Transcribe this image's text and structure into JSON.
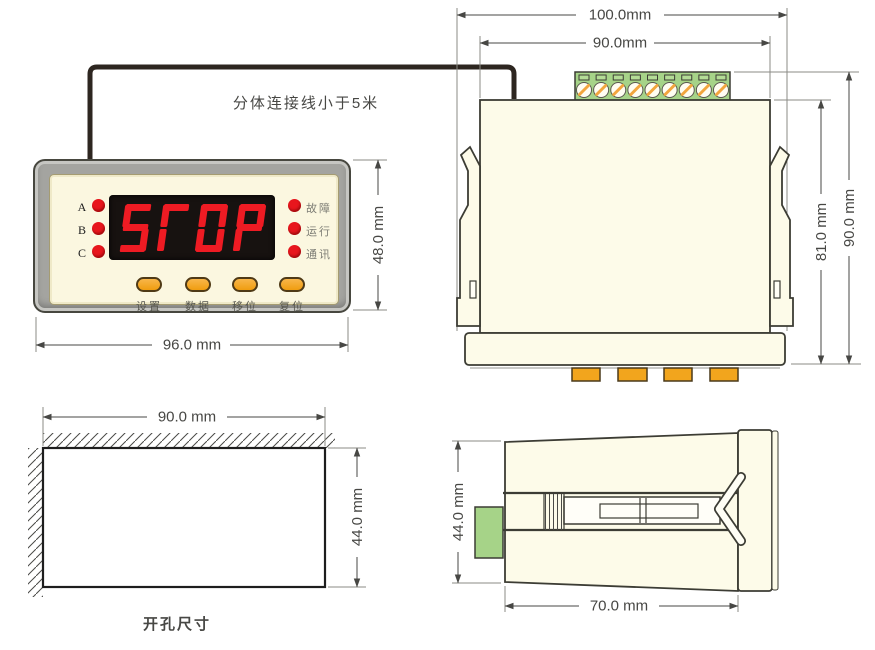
{
  "note": {
    "cable_text": "分体连接线小于5米"
  },
  "front_view": {
    "display_text": "STOP",
    "phase_leds": [
      "A",
      "B",
      "C"
    ],
    "status_leds": [
      "故障",
      "运行",
      "通讯"
    ],
    "buttons": [
      "设置",
      "数据",
      "移位",
      "复位"
    ],
    "dim_width": "96.0 mm",
    "dim_height": "48.0 mm"
  },
  "rear_view": {
    "terminal_screws": 9,
    "dim_outer_width": "100.0mm",
    "dim_inner_width": "90.0mm",
    "dim_body_height": "81.0 mm",
    "dim_total_height": "90.0 mm"
  },
  "cutout_view": {
    "dim_width": "90.0 mm",
    "dim_height": "44.0 mm",
    "label": "开孔尺寸"
  },
  "side_view": {
    "dim_height": "44.0 mm",
    "dim_depth": "70.0 mm"
  },
  "colors": {
    "red": "#ee1b23",
    "orange": "#f2a51d",
    "green": "#a6d388",
    "cream": "#fdfbe9",
    "bezel_gray": "#a4a4a0",
    "display_black": "#171210",
    "line": "#3c3c34",
    "dim_text": "#474744"
  }
}
